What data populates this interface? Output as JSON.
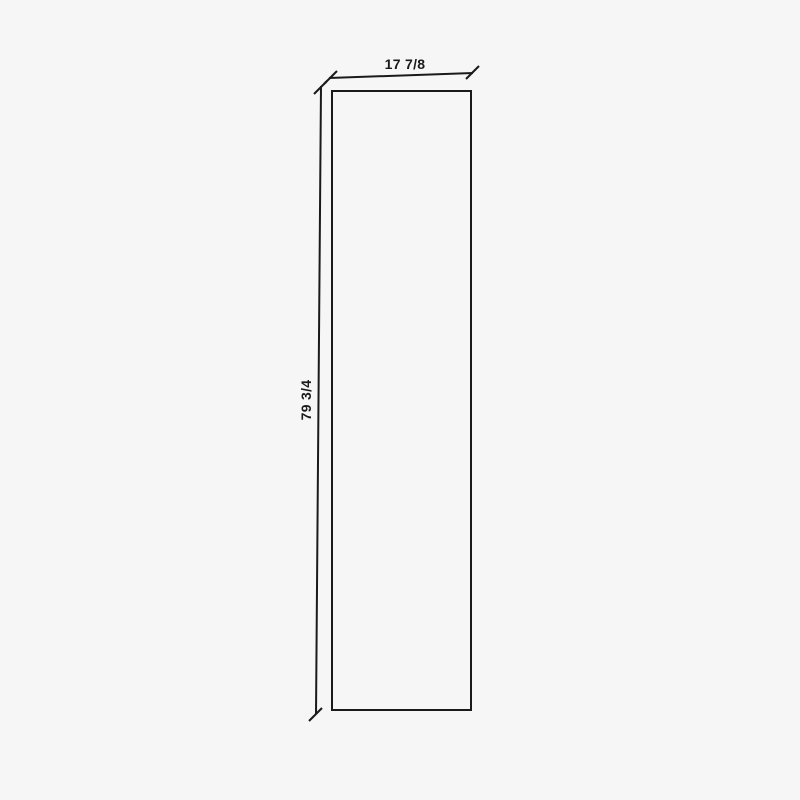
{
  "diagram": {
    "width_label": "17 7/8",
    "height_label": "79 3/4",
    "colors": {
      "background": "#f6f6f6",
      "line": "#1a1a1a",
      "text": "#1a1a1a"
    }
  }
}
